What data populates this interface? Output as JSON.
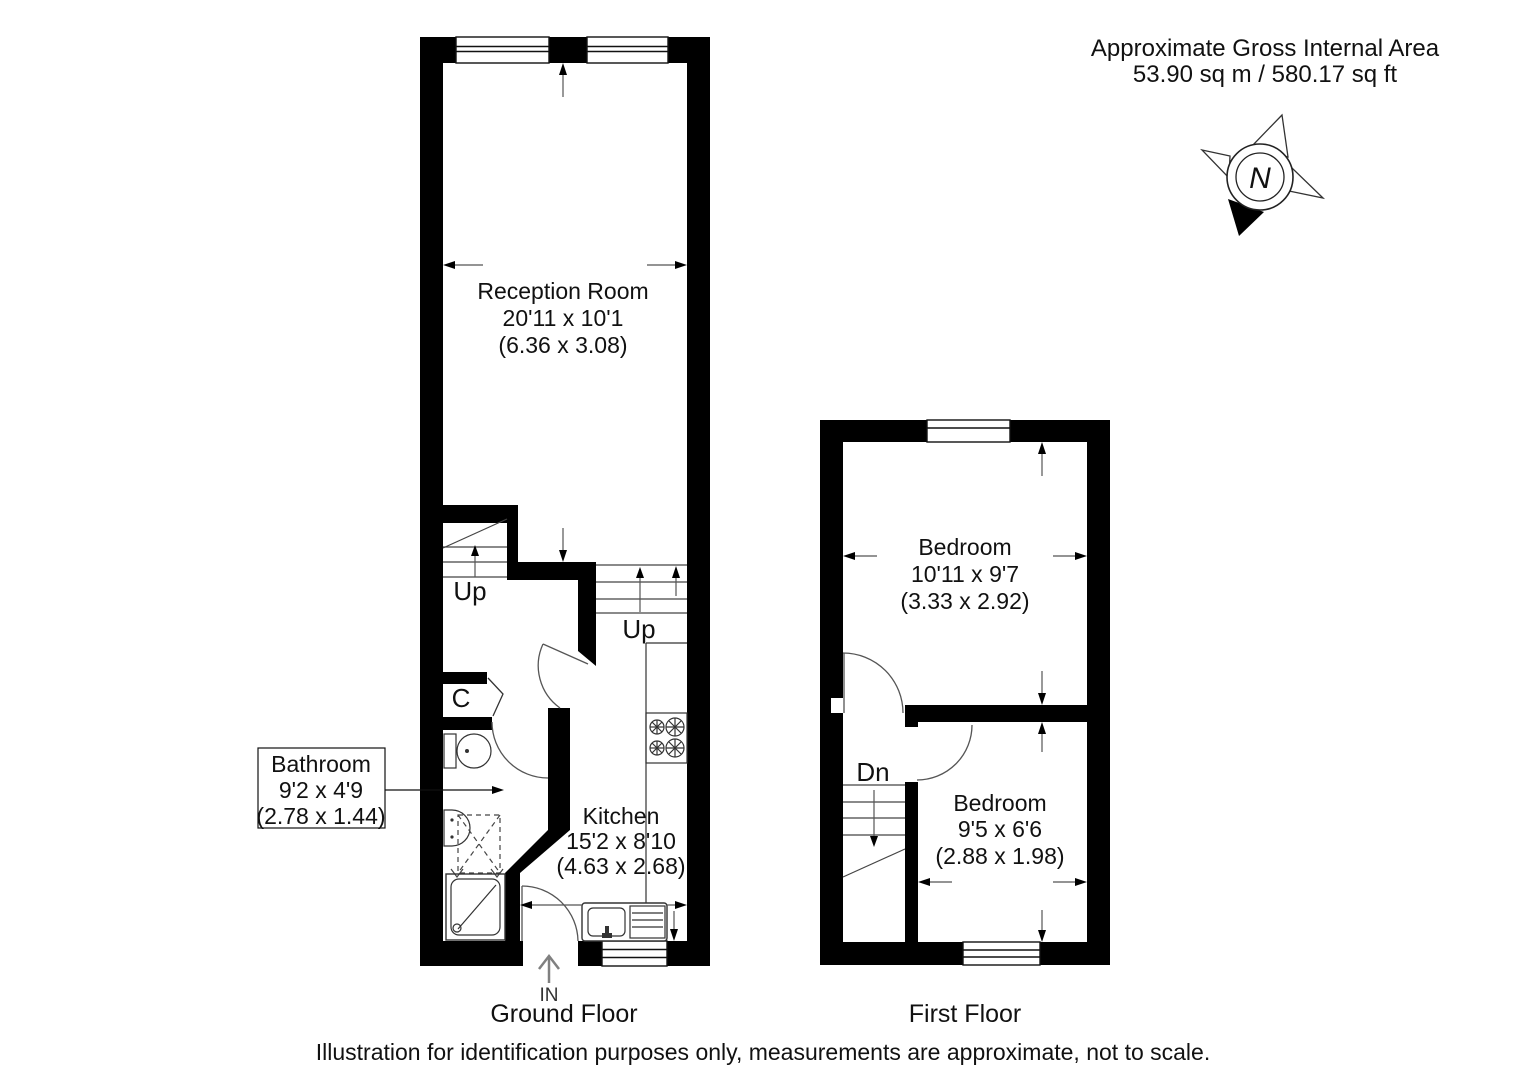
{
  "header": {
    "title": "Approximate Gross Internal Area",
    "area": "53.90 sq m / 580.17 sq ft"
  },
  "compass": {
    "north_label": "N"
  },
  "ground_floor": {
    "caption": "Ground Floor",
    "reception": {
      "name": "Reception Room",
      "imperial": "20'11 x 10'1",
      "metric": "(6.36 x 3.08)"
    },
    "kitchen": {
      "name": "Kitchen",
      "imperial": "15'2 x 8'10",
      "metric": "(4.63 x 2.68)"
    },
    "bathroom": {
      "name": "Bathroom",
      "imperial": "9'2 x 4'9",
      "metric": "(2.78 x 1.44)"
    },
    "stairs_up_left": "Up",
    "stairs_up_right": "Up",
    "closet": "C",
    "entrance": "IN"
  },
  "first_floor": {
    "caption": "First Floor",
    "bedroom_front": {
      "name": "Bedroom",
      "imperial": "10'11 x 9'7",
      "metric": "(3.33 x 2.92)"
    },
    "bedroom_rear": {
      "name": "Bedroom",
      "imperial": "9'5 x 6'6",
      "metric": "(2.88 x 1.98)"
    },
    "stairs_down": "Dn"
  },
  "footer": {
    "disclaimer": "Illustration for identification purposes only, measurements are approximate, not to scale."
  },
  "colors": {
    "wall": "#000000",
    "thin_line": "#444444",
    "door_arc": "#555555",
    "in_arrow": "#808080",
    "text": "#111111",
    "background": "#ffffff"
  }
}
